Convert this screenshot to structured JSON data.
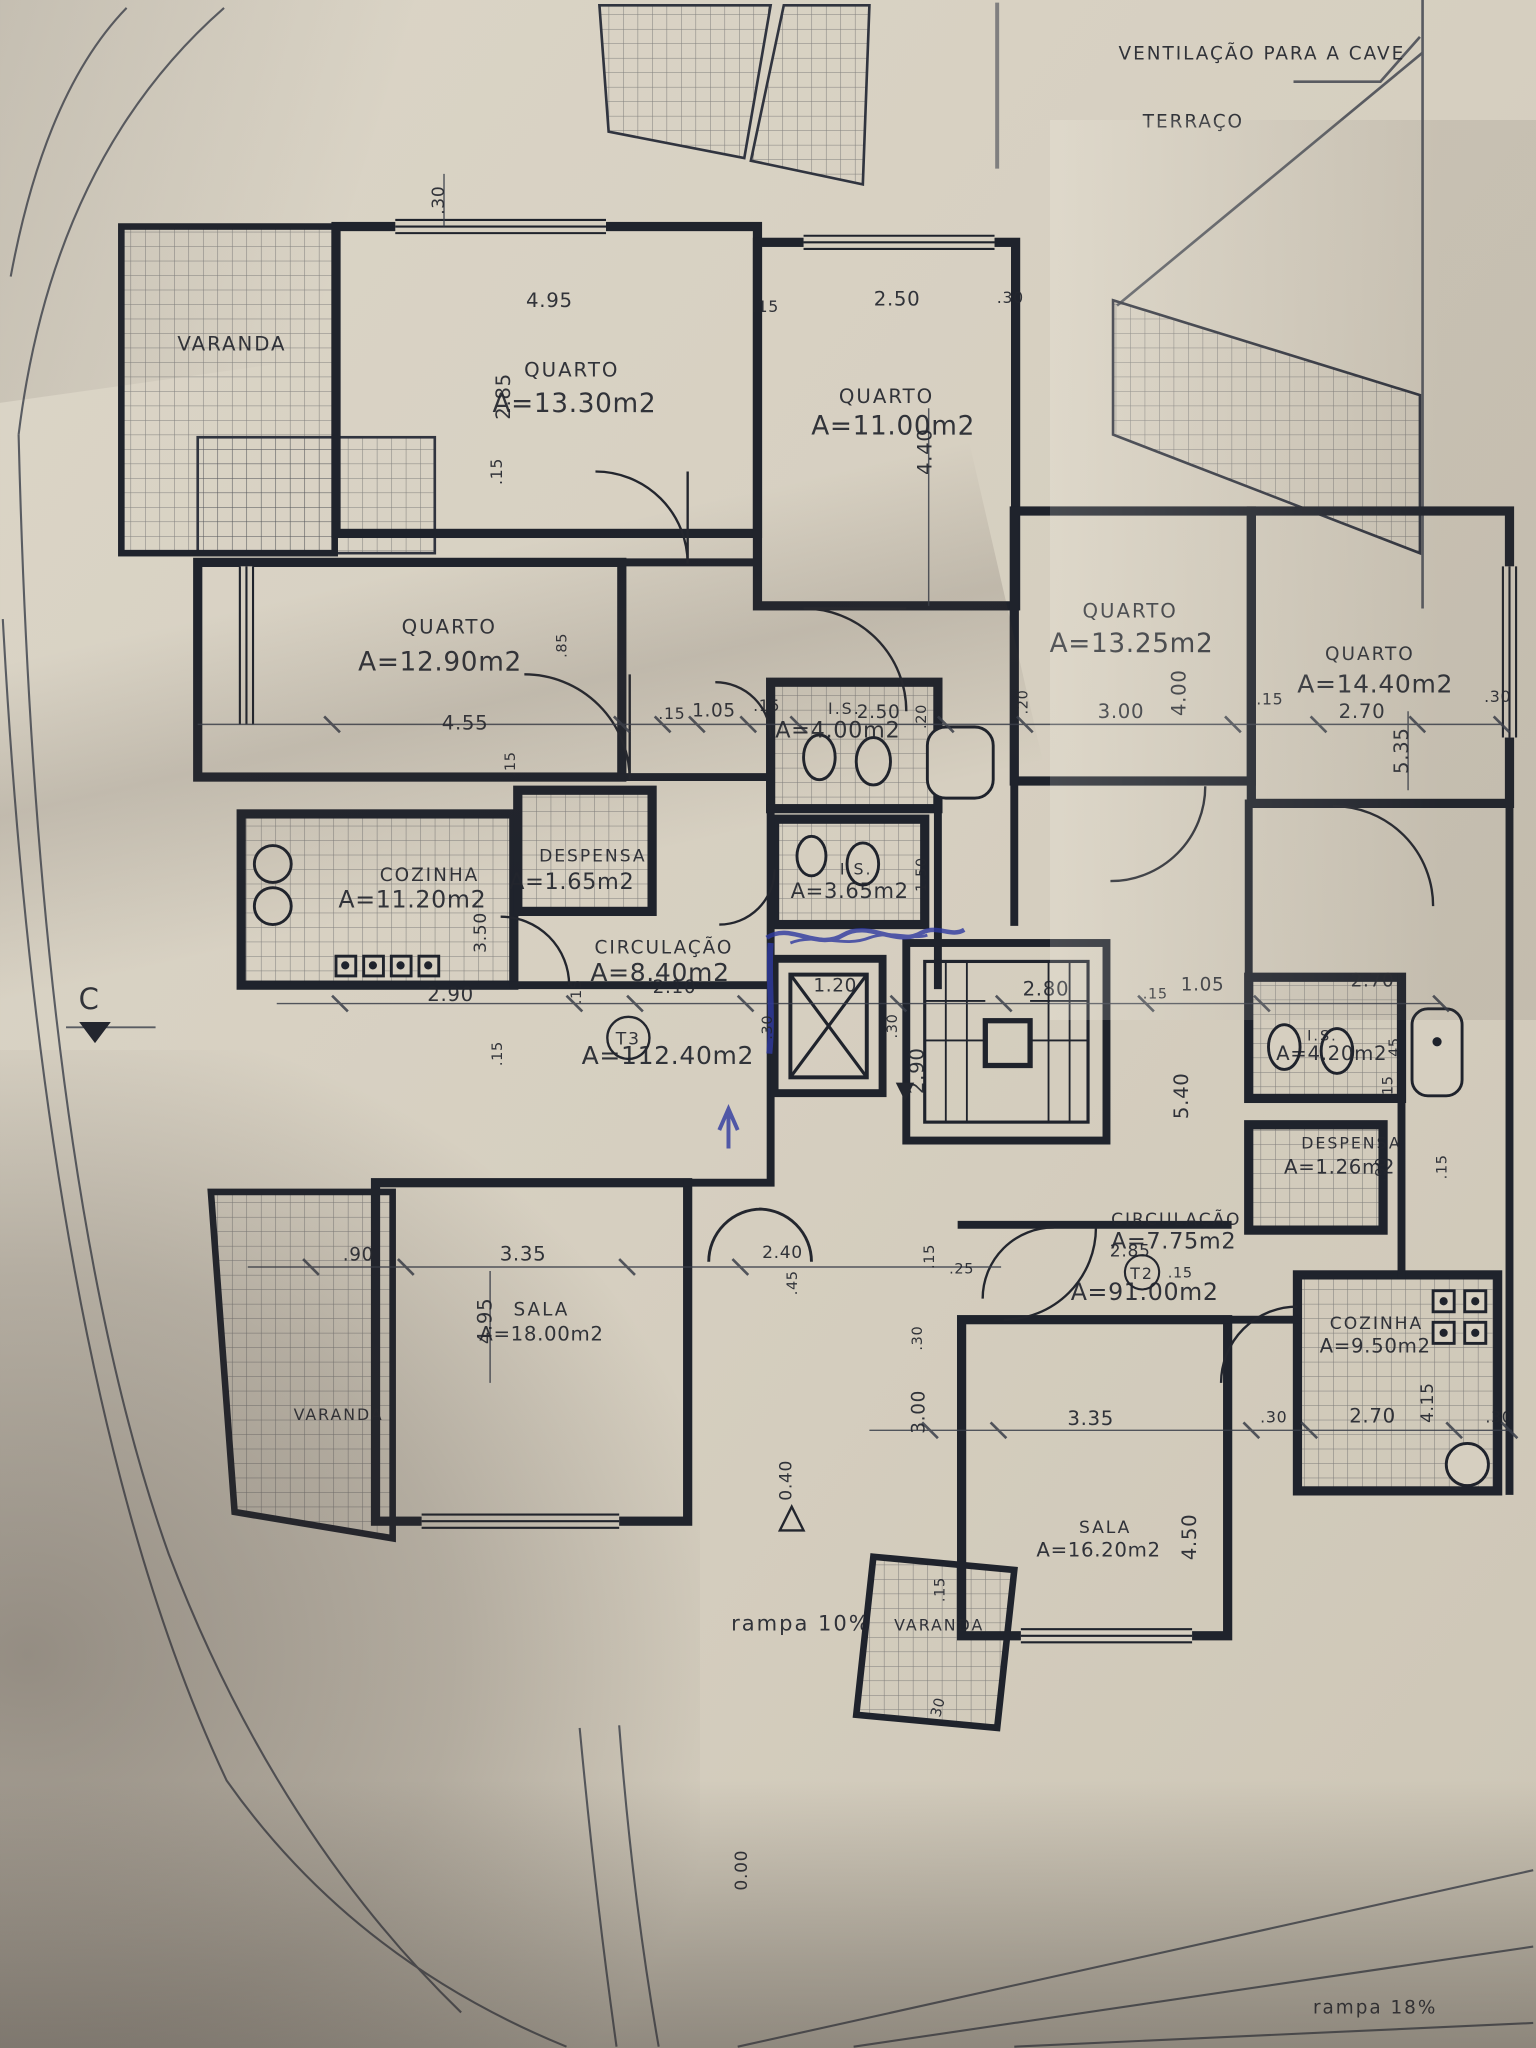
{
  "drawing": {
    "title": "Planta de piso — apartamentos T3 e T2",
    "apartments": [
      {
        "tag": "T3",
        "area_label": "A=112.40m2"
      },
      {
        "tag": "T2",
        "area_label": "A=91.00m2"
      }
    ],
    "colors": {
      "paper": "#d6cfc0",
      "ink": "#23262e",
      "blue_pen": "#2f3aa0",
      "tile_line": "#2b2f3a"
    }
  },
  "annotations": [
    {
      "id": "ventilacao",
      "text": "VENTILAÇÃO PARA A CAVE",
      "x": 958,
      "y": 45,
      "size": 14,
      "kind": "note"
    },
    {
      "id": "terraco",
      "text": "TERRAÇO",
      "x": 906,
      "y": 97,
      "size": 14,
      "kind": "note"
    },
    {
      "id": "varanda-top-left",
      "text": "VARANDA",
      "x": 176,
      "y": 266,
      "size": 15,
      "kind": "room"
    },
    {
      "id": "quarto-1-name",
      "text": "QUARTO",
      "x": 434,
      "y": 286,
      "size": 15,
      "kind": "room"
    },
    {
      "id": "quarto-1-area",
      "text": "A=13.30m2",
      "x": 436,
      "y": 313,
      "size": 20,
      "kind": "area"
    },
    {
      "id": "quarto-2-name",
      "text": "QUARTO",
      "x": 673,
      "y": 306,
      "size": 15,
      "kind": "room"
    },
    {
      "id": "quarto-2-area",
      "text": "A=11.00m2",
      "x": 678,
      "y": 330,
      "size": 20,
      "kind": "area"
    },
    {
      "id": "quarto-3-name",
      "text": "QUARTO",
      "x": 341,
      "y": 481,
      "size": 15,
      "kind": "room"
    },
    {
      "id": "quarto-3-area",
      "text": "A=12.90m2",
      "x": 334,
      "y": 509,
      "size": 20,
      "kind": "area"
    },
    {
      "id": "quarto-4-name",
      "text": "QUARTO",
      "x": 858,
      "y": 469,
      "size": 15,
      "kind": "room"
    },
    {
      "id": "quarto-4-area",
      "text": "A=13.25m2",
      "x": 859,
      "y": 495,
      "size": 20,
      "kind": "area"
    },
    {
      "id": "quarto-5-name",
      "text": "QUARTO",
      "x": 1040,
      "y": 501,
      "size": 14,
      "kind": "room"
    },
    {
      "id": "quarto-5-area",
      "text": "A=14.40m2",
      "x": 1044,
      "y": 526,
      "size": 19,
      "kind": "area"
    },
    {
      "id": "cozinha-1-name",
      "text": "COZINHA",
      "x": 326,
      "y": 669,
      "size": 14,
      "kind": "room"
    },
    {
      "id": "cozinha-1-area",
      "text": "A=11.20m2",
      "x": 313,
      "y": 689,
      "size": 18,
      "kind": "area"
    },
    {
      "id": "despensa-1-name",
      "text": "DESPENSA",
      "x": 450,
      "y": 654,
      "size": 13,
      "kind": "room"
    },
    {
      "id": "despensa-1-area",
      "text": "A=1.65m2",
      "x": 434,
      "y": 675,
      "size": 17,
      "kind": "area"
    },
    {
      "id": "is-1-name",
      "text": "I.S.",
      "x": 641,
      "y": 542,
      "size": 12,
      "kind": "room"
    },
    {
      "id": "is-1-area",
      "text": "A=4.00m2",
      "x": 636,
      "y": 560,
      "size": 17,
      "kind": "area"
    },
    {
      "id": "is-2-name",
      "text": "I.S.",
      "x": 650,
      "y": 664,
      "size": 12,
      "kind": "room"
    },
    {
      "id": "is-2-area",
      "text": "A=3.65m2",
      "x": 645,
      "y": 682,
      "size": 16,
      "kind": "area"
    },
    {
      "id": "circulacao-1-name",
      "text": "CIRCULAÇÃO",
      "x": 504,
      "y": 724,
      "size": 14,
      "kind": "room"
    },
    {
      "id": "circulacao-1-area",
      "text": "A=8.40m2",
      "x": 501,
      "y": 745,
      "size": 19,
      "kind": "area"
    },
    {
      "id": "t3-tag",
      "text": "T3",
      "x": 477,
      "y": 793,
      "size": 13,
      "kind": "room"
    },
    {
      "id": "t3-area",
      "text": "A=112.40m2",
      "x": 507,
      "y": 808,
      "size": 19,
      "kind": "area"
    },
    {
      "id": "is-3-name",
      "text": "I.S.",
      "x": 1004,
      "y": 790,
      "size": 11,
      "kind": "room"
    },
    {
      "id": "is-3-area",
      "text": "A=4.20m2",
      "x": 1011,
      "y": 805,
      "size": 15,
      "kind": "area"
    },
    {
      "id": "despensa-2-name",
      "text": "DESPENSA",
      "x": 1026,
      "y": 872,
      "size": 12,
      "kind": "room"
    },
    {
      "id": "despensa-2-area",
      "text": "A=1.26m2",
      "x": 1017,
      "y": 891,
      "size": 15,
      "kind": "area"
    },
    {
      "id": "circulacao-2-name",
      "text": "CIRCULAÇÃO",
      "x": 893,
      "y": 930,
      "size": 13,
      "kind": "room"
    },
    {
      "id": "circulacao-2-area",
      "text": "A=7.75m2",
      "x": 891,
      "y": 948,
      "size": 17,
      "kind": "area"
    },
    {
      "id": "t2-tag",
      "text": "T2",
      "x": 867,
      "y": 971,
      "size": 12,
      "kind": "room"
    },
    {
      "id": "t2-area",
      "text": "A=91.00m2",
      "x": 869,
      "y": 987,
      "size": 18,
      "kind": "area"
    },
    {
      "id": "cozinha-2-name",
      "text": "COZINHA",
      "x": 1045,
      "y": 1009,
      "size": 13,
      "kind": "room"
    },
    {
      "id": "cozinha-2-area",
      "text": "A=9.50m2",
      "x": 1044,
      "y": 1027,
      "size": 15,
      "kind": "area"
    },
    {
      "id": "sala-1-name",
      "text": "SALA",
      "x": 411,
      "y": 999,
      "size": 14,
      "kind": "room"
    },
    {
      "id": "sala-1-area",
      "text": "A=18.00m2",
      "x": 411,
      "y": 1018,
      "size": 15,
      "kind": "area"
    },
    {
      "id": "sala-2-name",
      "text": "SALA",
      "x": 839,
      "y": 1164,
      "size": 13,
      "kind": "room"
    },
    {
      "id": "sala-2-area",
      "text": "A=16.20m2",
      "x": 834,
      "y": 1182,
      "size": 15,
      "kind": "area"
    },
    {
      "id": "varanda-left",
      "text": "VARANDA",
      "x": 257,
      "y": 1078,
      "size": 12,
      "kind": "room"
    },
    {
      "id": "varanda-bottom",
      "text": "VARANDA",
      "x": 713,
      "y": 1238,
      "size": 12,
      "kind": "room"
    },
    {
      "id": "rampa-10",
      "text": "rampa 10%",
      "x": 608,
      "y": 1238,
      "size": 16,
      "kind": "note"
    },
    {
      "id": "rampa-18",
      "text": "rampa 18%",
      "x": 1044,
      "y": 1529,
      "size": 14,
      "kind": "note"
    },
    {
      "id": "section-c",
      "text": "C",
      "x": 68,
      "y": 766,
      "size": 22,
      "kind": "note"
    },
    {
      "id": "level-0-40",
      "text": "0.40",
      "x": 601,
      "y": 1124,
      "rot": -90,
      "size": 13,
      "kind": "dim"
    },
    {
      "id": "level-0-00",
      "text": "0.00",
      "x": 567,
      "y": 1420,
      "rot": -90,
      "size": 13,
      "kind": "dim"
    },
    {
      "id": "dim-30-a",
      "text": ".30",
      "x": 337,
      "y": 152,
      "rot": -90,
      "size": 13,
      "kind": "dim"
    },
    {
      "id": "dim-495-a",
      "text": "4.95",
      "x": 417,
      "y": 233,
      "size": 15,
      "kind": "dim"
    },
    {
      "id": "dim-15-a",
      "text": ".15",
      "x": 581,
      "y": 237,
      "size": 12,
      "kind": "dim"
    },
    {
      "id": "dim-250-a",
      "text": "2.50",
      "x": 681,
      "y": 232,
      "size": 15,
      "kind": "dim"
    },
    {
      "id": "dim-30-b",
      "text": ".30",
      "x": 767,
      "y": 230,
      "size": 12,
      "kind": "dim"
    },
    {
      "id": "dim-285-v",
      "text": "2.85",
      "x": 387,
      "y": 301,
      "rot": -90,
      "size": 15,
      "kind": "dim"
    },
    {
      "id": "dim-440-v",
      "text": "4.40",
      "x": 707,
      "y": 343,
      "rot": -90,
      "size": 15,
      "kind": "dim"
    },
    {
      "id": "dim-15-b",
      "text": ".15",
      "x": 381,
      "y": 358,
      "rot": -90,
      "size": 12,
      "kind": "dim"
    },
    {
      "id": "dim-85-v",
      "text": ".85",
      "x": 430,
      "y": 490,
      "rot": -90,
      "size": 11,
      "kind": "dim"
    },
    {
      "id": "dim-455",
      "text": "4.55",
      "x": 353,
      "y": 554,
      "size": 15,
      "kind": "dim"
    },
    {
      "id": "dim-15-c",
      "text": ".15",
      "x": 391,
      "y": 580,
      "rot": -90,
      "size": 11,
      "kind": "dim"
    },
    {
      "id": "dim-15-d",
      "text": ".15",
      "x": 510,
      "y": 546,
      "size": 12,
      "kind": "dim"
    },
    {
      "id": "dim-105-a",
      "text": "1.05",
      "x": 542,
      "y": 544,
      "size": 14,
      "kind": "dim"
    },
    {
      "id": "dim-15-e",
      "text": ".15",
      "x": 582,
      "y": 540,
      "size": 12,
      "kind": "dim"
    },
    {
      "id": "dim-250-b",
      "text": "2.50",
      "x": 667,
      "y": 545,
      "size": 14,
      "kind": "dim"
    },
    {
      "id": "dim-20-a",
      "text": ".20",
      "x": 703,
      "y": 544,
      "rot": -90,
      "size": 11,
      "kind": "dim"
    },
    {
      "id": "dim-20-b",
      "text": ".20",
      "x": 780,
      "y": 533,
      "rot": -90,
      "size": 11,
      "kind": "dim"
    },
    {
      "id": "dim-300-a",
      "text": "3.00",
      "x": 851,
      "y": 545,
      "size": 15,
      "kind": "dim"
    },
    {
      "id": "dim-400-v",
      "text": "4.00",
      "x": 900,
      "y": 526,
      "rot": -90,
      "size": 15,
      "kind": "dim"
    },
    {
      "id": "dim-15-f",
      "text": ".15",
      "x": 964,
      "y": 535,
      "size": 12,
      "kind": "dim"
    },
    {
      "id": "dim-270-a",
      "text": "2.70",
      "x": 1034,
      "y": 545,
      "size": 15,
      "kind": "dim"
    },
    {
      "id": "dim-535-v",
      "text": "5.35",
      "x": 1069,
      "y": 570,
      "rot": -90,
      "size": 15,
      "kind": "dim"
    },
    {
      "id": "dim-30-c",
      "text": ".30",
      "x": 1137,
      "y": 533,
      "size": 12,
      "kind": "dim"
    },
    {
      "id": "dim-150-v",
      "text": "1.50",
      "x": 703,
      "y": 664,
      "rot": -90,
      "size": 11,
      "kind": "dim"
    },
    {
      "id": "dim-350-v",
      "text": "3.50",
      "x": 369,
      "y": 708,
      "rot": -90,
      "size": 13,
      "kind": "dim"
    },
    {
      "id": "dim-290-a",
      "text": "2.90",
      "x": 342,
      "y": 760,
      "size": 15,
      "kind": "dim"
    },
    {
      "id": "dim-15-g",
      "text": ".15",
      "x": 441,
      "y": 753,
      "rot": -90,
      "size": 11,
      "kind": "dim"
    },
    {
      "id": "dim-210",
      "text": "2.10",
      "x": 512,
      "y": 754,
      "size": 14,
      "kind": "dim"
    },
    {
      "id": "dim-120",
      "text": "1.20",
      "x": 634,
      "y": 753,
      "size": 14,
      "kind": "dim"
    },
    {
      "id": "dim-30-d",
      "text": ".30",
      "x": 586,
      "y": 780,
      "rot": -90,
      "size": 11,
      "kind": "dim"
    },
    {
      "id": "dim-30-e",
      "text": ".30",
      "x": 681,
      "y": 779,
      "rot": -90,
      "size": 11,
      "kind": "dim"
    },
    {
      "id": "dim-290-v",
      "text": "2.90",
      "x": 701,
      "y": 813,
      "rot": -90,
      "size": 15,
      "kind": "dim"
    },
    {
      "id": "dim-280",
      "text": "2.80",
      "x": 794,
      "y": 756,
      "size": 15,
      "kind": "dim"
    },
    {
      "id": "dim-15-h",
      "text": ".15",
      "x": 877,
      "y": 758,
      "size": 11,
      "kind": "dim"
    },
    {
      "id": "dim-105-b",
      "text": "1.05",
      "x": 913,
      "y": 752,
      "size": 14,
      "kind": "dim"
    },
    {
      "id": "dim-270-b",
      "text": "2.70",
      "x": 1042,
      "y": 749,
      "size": 14,
      "kind": "dim"
    },
    {
      "id": "dim-540-v",
      "text": "5.40",
      "x": 902,
      "y": 832,
      "rot": -90,
      "size": 15,
      "kind": "dim"
    },
    {
      "id": "dim-45-a",
      "text": ".45",
      "x": 1062,
      "y": 797,
      "rot": -90,
      "size": 11,
      "kind": "dim"
    },
    {
      "id": "dim-15-i",
      "text": ".15",
      "x": 1057,
      "y": 826,
      "rot": -90,
      "size": 11,
      "kind": "dim"
    },
    {
      "id": "dim-15-j",
      "text": ".15",
      "x": 1098,
      "y": 886,
      "rot": -90,
      "size": 11,
      "kind": "dim"
    },
    {
      "id": "dim-90-v",
      "text": ".90",
      "x": 1052,
      "y": 888,
      "rot": -90,
      "size": 11,
      "kind": "dim"
    },
    {
      "id": "dim-15-k",
      "text": ".15",
      "x": 381,
      "y": 800,
      "rot": -90,
      "size": 11,
      "kind": "dim"
    },
    {
      "id": "dim-90-a",
      "text": ".90",
      "x": 272,
      "y": 957,
      "size": 14,
      "kind": "dim"
    },
    {
      "id": "dim-335-a",
      "text": "3.35",
      "x": 397,
      "y": 957,
      "size": 15,
      "kind": "dim"
    },
    {
      "id": "dim-495-v",
      "text": "4.95",
      "x": 373,
      "y": 1003,
      "rot": -90,
      "size": 15,
      "kind": "dim"
    },
    {
      "id": "dim-240",
      "text": "2.40",
      "x": 594,
      "y": 955,
      "size": 13,
      "kind": "dim"
    },
    {
      "id": "dim-45-b",
      "text": ".45",
      "x": 605,
      "y": 974,
      "rot": -90,
      "size": 11,
      "kind": "dim"
    },
    {
      "id": "dim-25-a",
      "text": ".25",
      "x": 730,
      "y": 967,
      "size": 11,
      "kind": "dim"
    },
    {
      "id": "dim-15-l",
      "text": ".15",
      "x": 709,
      "y": 954,
      "rot": -90,
      "size": 11,
      "kind": "dim"
    },
    {
      "id": "dim-285-b",
      "text": "2.85",
      "x": 858,
      "y": 954,
      "size": 13,
      "kind": "dim"
    },
    {
      "id": "dim-15-m",
      "text": ".15",
      "x": 896,
      "y": 970,
      "size": 11,
      "kind": "dim"
    },
    {
      "id": "dim-30-f",
      "text": ".30",
      "x": 700,
      "y": 1016,
      "rot": -90,
      "size": 11,
      "kind": "dim"
    },
    {
      "id": "dim-300-v",
      "text": "3.00",
      "x": 702,
      "y": 1072,
      "rot": -90,
      "size": 14,
      "kind": "dim"
    },
    {
      "id": "dim-335-b",
      "text": "3.35",
      "x": 828,
      "y": 1082,
      "size": 15,
      "kind": "dim"
    },
    {
      "id": "dim-30-g",
      "text": ".30",
      "x": 967,
      "y": 1080,
      "size": 12,
      "kind": "dim"
    },
    {
      "id": "dim-270-c",
      "text": "2.70",
      "x": 1042,
      "y": 1080,
      "size": 15,
      "kind": "dim"
    },
    {
      "id": "dim-30-h",
      "text": ".30",
      "x": 1138,
      "y": 1080,
      "size": 12,
      "kind": "dim"
    },
    {
      "id": "dim-450-v",
      "text": "4.50",
      "x": 908,
      "y": 1167,
      "rot": -90,
      "size": 15,
      "kind": "dim"
    },
    {
      "id": "dim-415-v",
      "text": "4.15",
      "x": 1088,
      "y": 1065,
      "rot": -90,
      "size": 13,
      "kind": "dim"
    },
    {
      "id": "dim-15-n",
      "text": ".15",
      "x": 717,
      "y": 1207,
      "rot": -90,
      "size": 11,
      "kind": "dim"
    },
    {
      "id": "dim-30-i",
      "text": ".30",
      "x": 715,
      "y": 1299,
      "rot": -75,
      "size": 11,
      "kind": "dim"
    }
  ]
}
